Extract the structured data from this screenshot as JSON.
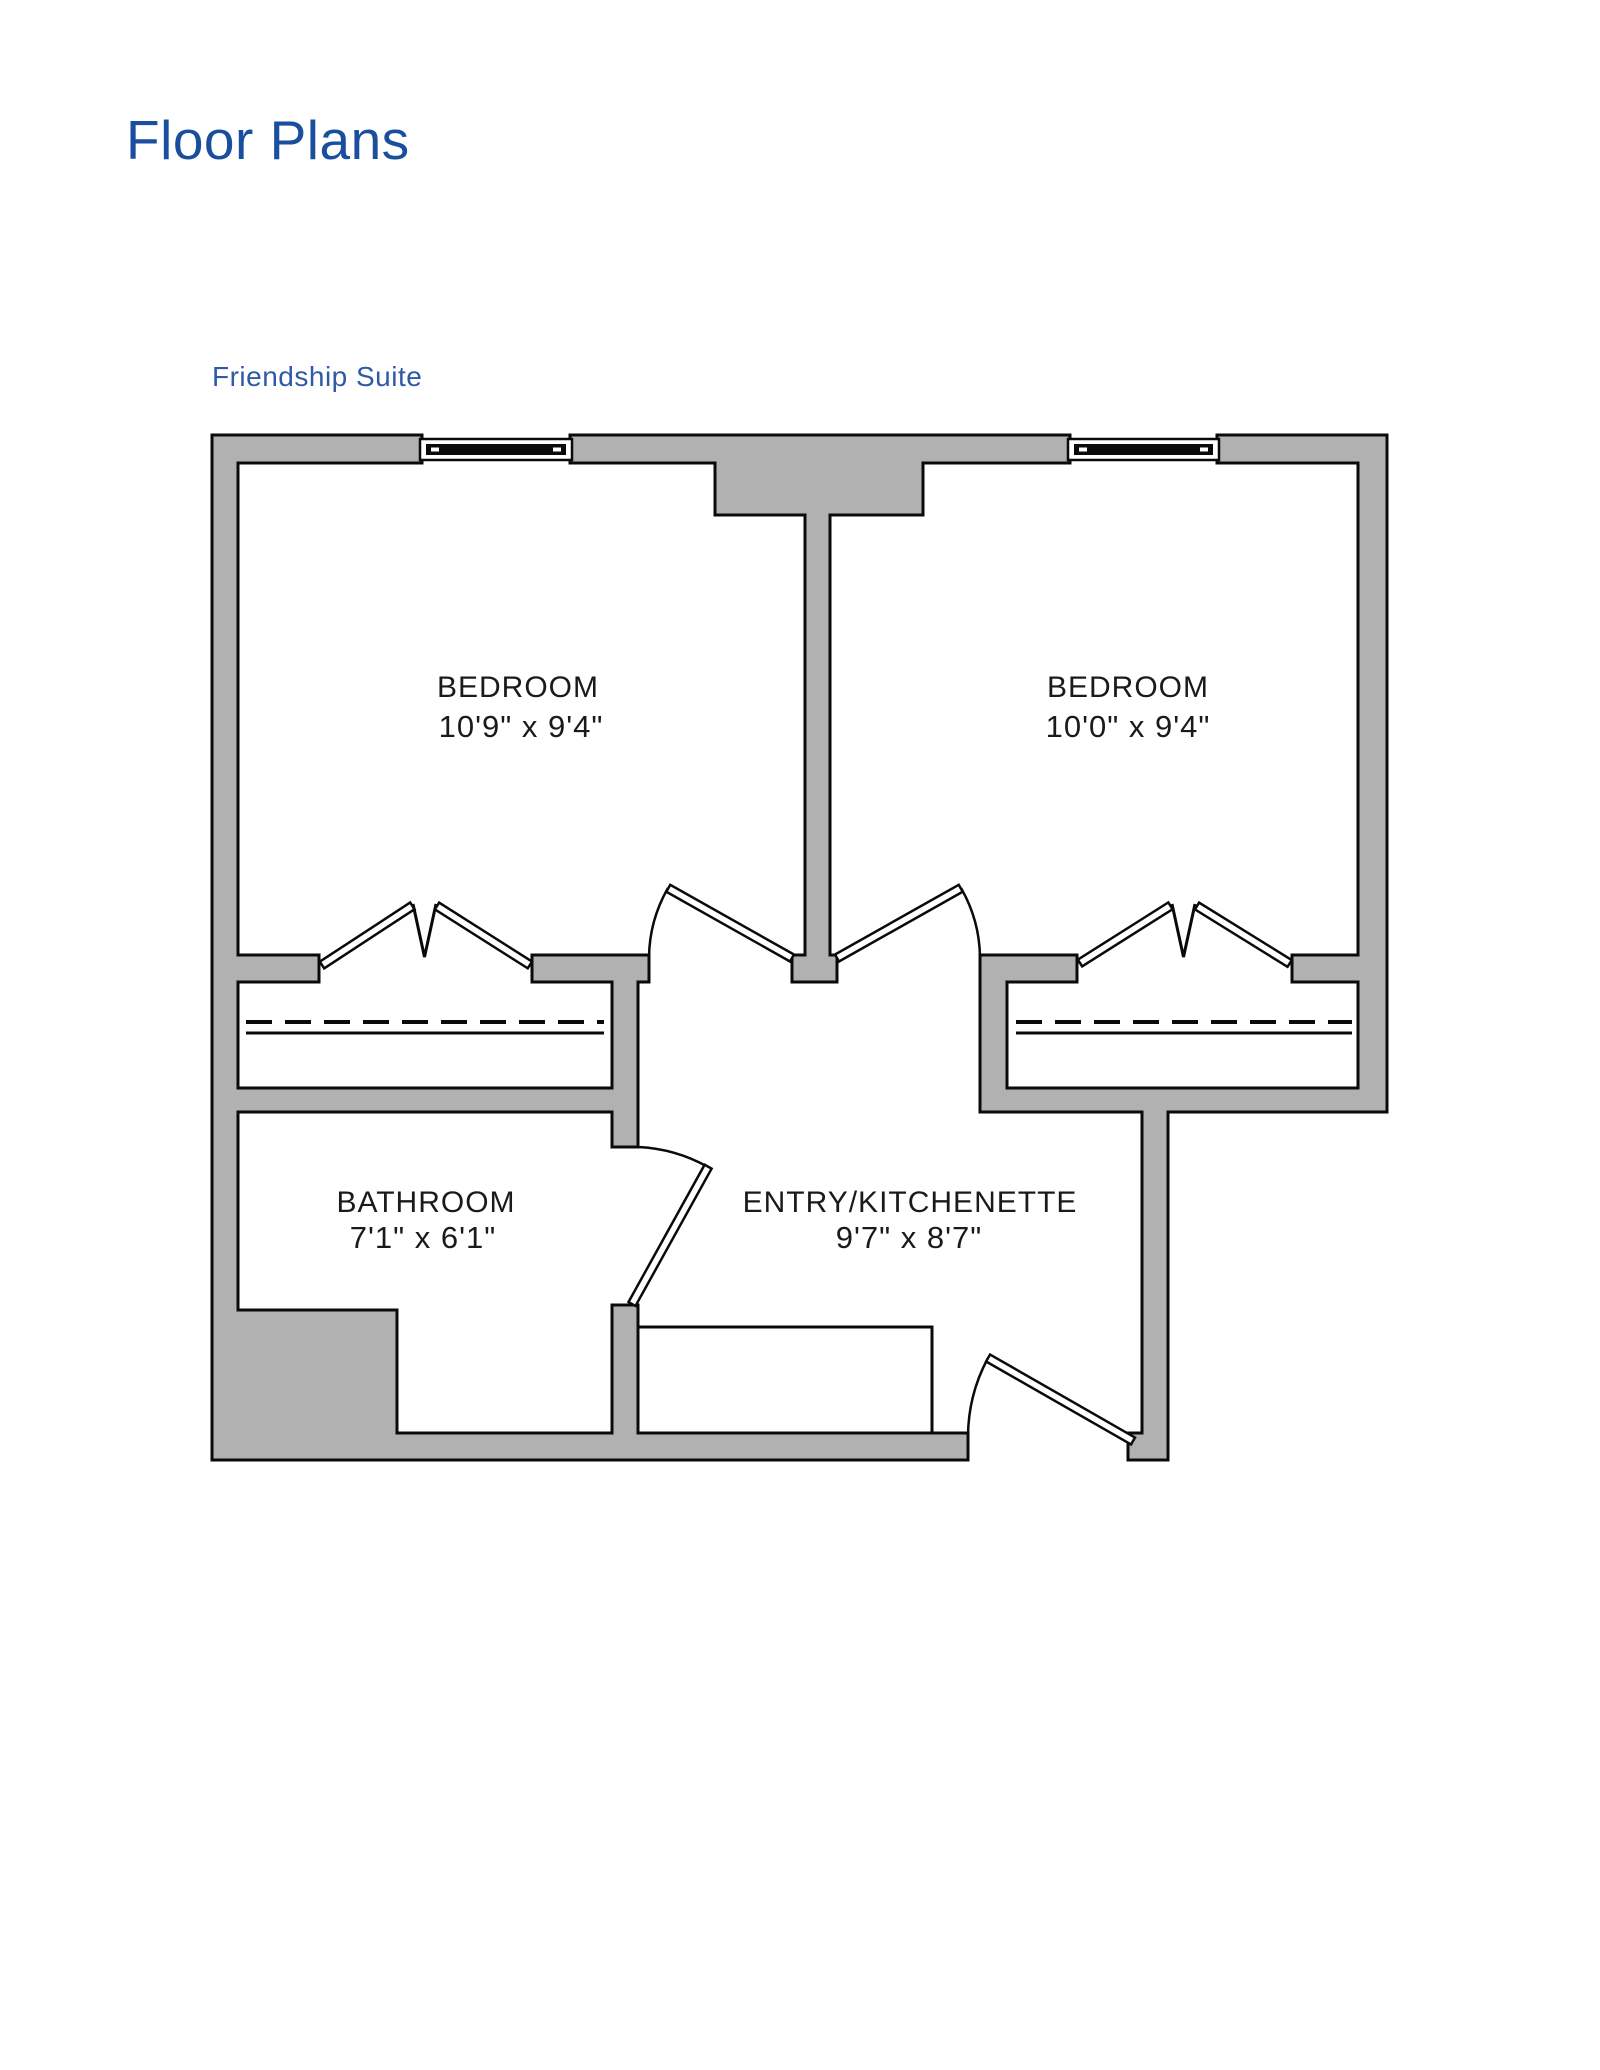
{
  "page": {
    "title": "Floor Plans",
    "subtitle": "Friendship Suite"
  },
  "rooms": [
    {
      "name": "BEDROOM",
      "dimensions": "10'9\" x 9'4\""
    },
    {
      "name": "BEDROOM",
      "dimensions": "10'0\" x 9'4\""
    },
    {
      "name": "BATHROOM",
      "dimensions": "7'1\" x 6'1\""
    },
    {
      "name": "ENTRY/KITCHENETTE",
      "dimensions": "9'7\" x 8'7\""
    }
  ],
  "theme": {
    "title_color": "#1a4e9e",
    "subtitle_color": "#2f5aa5",
    "wall_fill": "#b1b1b1",
    "line_color": "#0a0a0a",
    "label_color": "#1a1a1a",
    "paper": "#ffffff"
  }
}
